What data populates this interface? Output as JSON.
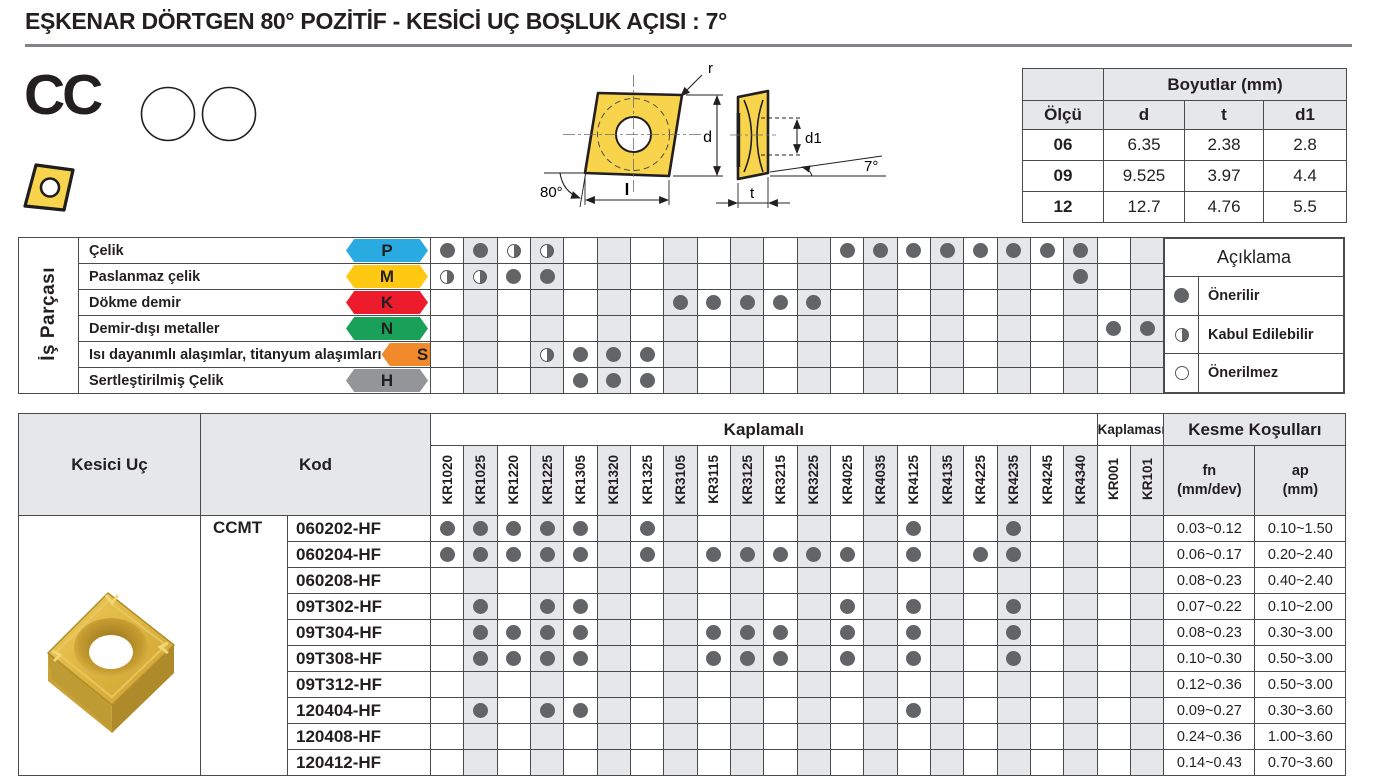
{
  "title": "EŞKENAR DÖRTGEN 80° POZİTİF - KESİCİ UÇ BOŞLUK AÇISI : 7°",
  "product_code": "CC",
  "drawing": {
    "r_label": "r",
    "d_label": "d",
    "l_label": "l",
    "front_angle_label": "80°",
    "d1_label": "d1",
    "t_label": "t",
    "side_angle_label": "7°"
  },
  "dimensions_table": {
    "group_header": "Boyutlar (mm)",
    "columns": [
      "Ölçü",
      "d",
      "t",
      "d1"
    ],
    "rows": [
      [
        "06",
        "6.35",
        "2.38",
        "2.8"
      ],
      [
        "09",
        "9.525",
        "3.97",
        "4.4"
      ],
      [
        "12",
        "12.7",
        "4.76",
        "5.5"
      ]
    ]
  },
  "materials": {
    "side_label": "İş Parçası",
    "rows": [
      {
        "name": "Çelik",
        "letter": "P",
        "color": "#29ABE2",
        "marks": [
          "F",
          "F",
          "H",
          "H",
          "",
          "",
          "",
          "",
          "",
          "",
          "",
          "",
          "F",
          "F",
          "F",
          "F",
          "F",
          "F",
          "F",
          "F",
          "",
          ""
        ]
      },
      {
        "name": "Paslanmaz çelik",
        "letter": "M",
        "color": "#FFC913",
        "marks": [
          "H",
          "H",
          "F",
          "F",
          "",
          "",
          "",
          "",
          "",
          "",
          "",
          "",
          "",
          "",
          "",
          "",
          "",
          "",
          "",
          "F",
          "",
          ""
        ]
      },
      {
        "name": "Dökme demir",
        "letter": "K",
        "color": "#EC1C2D",
        "marks": [
          "",
          "",
          "",
          "",
          "",
          "",
          "",
          "F",
          "F",
          "F",
          "F",
          "F",
          "",
          "",
          "",
          "",
          "",
          "",
          "",
          "",
          "",
          ""
        ]
      },
      {
        "name": "Demir-dışı metaller",
        "letter": "N",
        "color": "#19A159",
        "marks": [
          "",
          "",
          "",
          "",
          "",
          "",
          "",
          "",
          "",
          "",
          "",
          "",
          "",
          "",
          "",
          "",
          "",
          "",
          "",
          "",
          "F",
          "F"
        ]
      },
      {
        "name": "Isı dayanımlı alaşımlar, titanyum alaşımları",
        "letter": "S",
        "color": "#F18A2B",
        "marks": [
          "",
          "",
          "",
          "H",
          "F",
          "F",
          "F",
          "",
          "",
          "",
          "",
          "",
          "",
          "",
          "",
          "",
          "",
          "",
          "",
          "",
          "",
          ""
        ]
      },
      {
        "name": "Sertleştirilmiş Çelik",
        "letter": "H",
        "color": "#939598",
        "marks": [
          "",
          "",
          "",
          "",
          "F",
          "F",
          "F",
          "",
          "",
          "",
          "",
          "",
          "",
          "",
          "",
          "",
          "",
          "",
          "",
          "",
          "",
          ""
        ]
      }
    ]
  },
  "legend": {
    "title": "Açıklama",
    "items": [
      {
        "mark": "full",
        "label": "Önerilir"
      },
      {
        "mark": "half",
        "label": "Kabul Edilebilir"
      },
      {
        "mark": "empty",
        "label": "Önerilmez"
      }
    ]
  },
  "main_table": {
    "col_kesici_uc": "Kesici Uç",
    "col_kod": "Kod",
    "group_coated": "Kaplamalı",
    "group_uncoated": "Kaplamasız",
    "group_cutting": "Kesme Koşulları",
    "fn_line1": "fn",
    "fn_line2": "(mm/dev)",
    "ap_line1": "ap",
    "ap_line2": "(mm)",
    "coated_count": 20,
    "uncoated_count": 2,
    "grades": [
      "KR1020",
      "KR1025",
      "KR1220",
      "KR1225",
      "KR1305",
      "KR1320",
      "KR1325",
      "KR3105",
      "KR3115",
      "KR3125",
      "KR3215",
      "KR3225",
      "KR4025",
      "KR4035",
      "KR4125",
      "KR4135",
      "KR4225",
      "KR4235",
      "KR4245",
      "KR4340",
      "KR001",
      "KR101"
    ],
    "series": "CCMT",
    "rows": [
      {
        "code": "060202-HF",
        "dots": [
          1,
          2,
          3,
          4,
          5,
          7,
          15,
          18
        ],
        "fn": "0.03~0.12",
        "ap": "0.10~1.50"
      },
      {
        "code": "060204-HF",
        "dots": [
          1,
          2,
          3,
          4,
          5,
          7,
          9,
          10,
          11,
          12,
          13,
          15,
          17,
          18
        ],
        "fn": "0.06~0.17",
        "ap": "0.20~2.40"
      },
      {
        "code": "060208-HF",
        "dots": [],
        "fn": "0.08~0.23",
        "ap": "0.40~2.40"
      },
      {
        "code": "09T302-HF",
        "dots": [
          2,
          4,
          5,
          13,
          15,
          18
        ],
        "fn": "0.07~0.22",
        "ap": "0.10~2.00"
      },
      {
        "code": "09T304-HF",
        "dots": [
          2,
          3,
          4,
          5,
          9,
          10,
          11,
          13,
          15,
          18
        ],
        "fn": "0.08~0.23",
        "ap": "0.30~3.00"
      },
      {
        "code": "09T308-HF",
        "dots": [
          2,
          3,
          4,
          5,
          9,
          10,
          11,
          13,
          15,
          18
        ],
        "fn": "0.10~0.30",
        "ap": "0.50~3.00"
      },
      {
        "code": "09T312-HF",
        "dots": [],
        "fn": "0.12~0.36",
        "ap": "0.50~3.00"
      },
      {
        "code": "120404-HF",
        "dots": [
          2,
          4,
          5,
          15
        ],
        "fn": "0.09~0.27",
        "ap": "0.30~3.60"
      },
      {
        "code": "120408-HF",
        "dots": [],
        "fn": "0.24~0.36",
        "ap": "1.00~3.60"
      },
      {
        "code": "120412-HF",
        "dots": [],
        "fn": "0.14~0.43",
        "ap": "0.70~3.60"
      }
    ]
  },
  "colors": {
    "border": "#4A4B4E",
    "shade": "#E6E7E8",
    "dot": "#636466",
    "insert_yellow": "#F8D44C",
    "rule_gray": "#808285"
  }
}
